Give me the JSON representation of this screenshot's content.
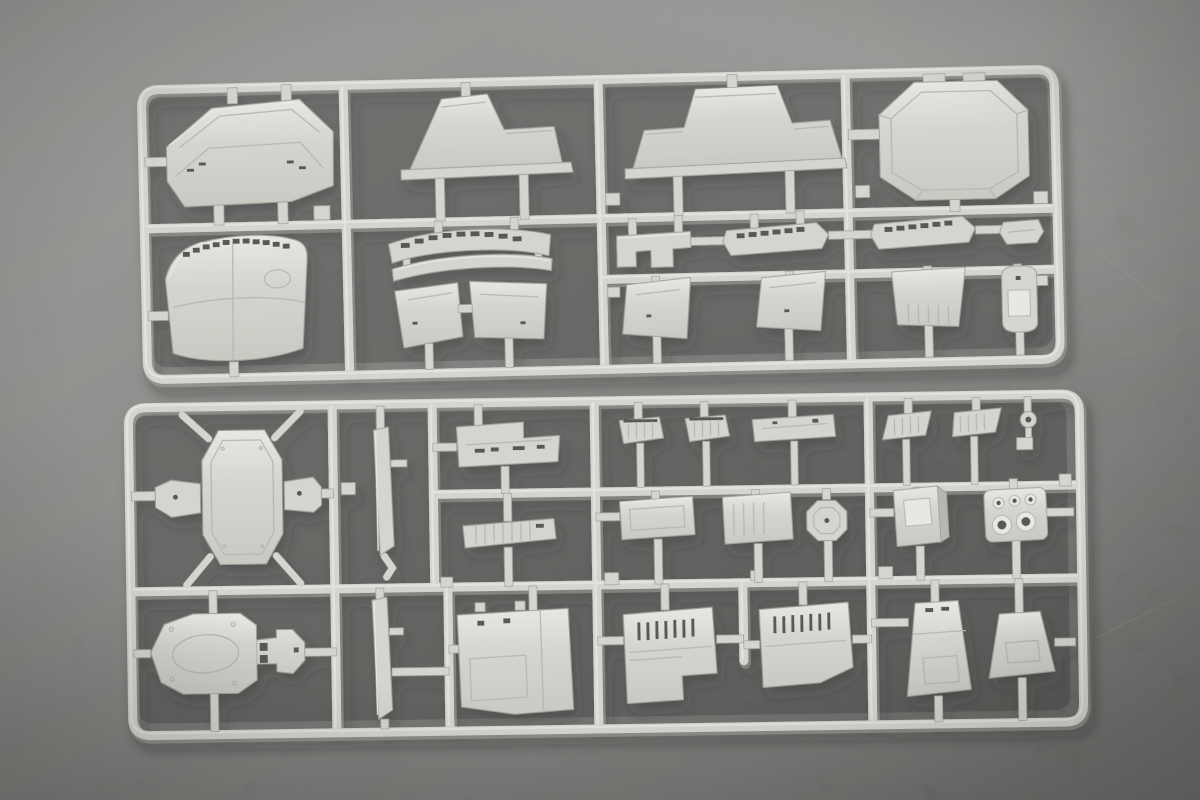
{
  "scene": {
    "type": "product photograph",
    "subject": "Two light-grey injection-moulded polystyrene sprues (part frames) of an unassembled plastic model warship kit, lying on a dark grey mottled backdrop",
    "description": "Photograph of two plastic model kit sprues containing ship superstructure panels, deck platforms, vents, funnels and hatches in light grey styrene on a dark grey textured background",
    "sprue_count": 2,
    "text_visible": "none"
  },
  "colors": {
    "bg_light": "#8f8f8d",
    "bg_mid": "#747472",
    "bg_dark": "#4f4f4d",
    "plastic_base": "#d8d7d1",
    "plastic_highlight": "#efeee9",
    "plastic_mid_shade": "#c9c8c1",
    "plastic_shadow": "#b2b1aa",
    "plastic_edge": "#96958e",
    "slot_color": "#3a3a37",
    "interior_shadow": "rgba(16,16,14,0.26)",
    "cast_shadow": "#171715"
  },
  "sprues": [
    {
      "id": "sprue-top",
      "label": "upper sprue",
      "aria": "Upper sprue with large superstructure and deckhouse panels",
      "parts": [
        {
          "id": "a1",
          "desc": "chamfered transom plate with bevelled panel lines"
        },
        {
          "id": "a2",
          "desc": "stepped deckhouse side profile, left-hand"
        },
        {
          "id": "a3",
          "desc": "stepped deckhouse side profile, right-hand, with base flange"
        },
        {
          "id": "a4",
          "desc": "large chamfered deckhouse rear panel with inner bevel"
        },
        {
          "id": "a5",
          "desc": "curved bridge shroud panel with row of dark window slots"
        },
        {
          "id": "a6",
          "desc": "curved bridge window strip with dark slots"
        },
        {
          "id": "a7",
          "desc": "thin curved trim strip"
        },
        {
          "id": "a8",
          "desc": "pair of angled bulkhead panels"
        },
        {
          "id": "a9",
          "desc": "goalpost bracket fitting"
        },
        {
          "id": "a10",
          "desc": "slanted window strip A with dark slots"
        },
        {
          "id": "a11",
          "desc": "slanted window strip B with dark slots"
        },
        {
          "id": "a12",
          "desc": "small trapezoid tab"
        },
        {
          "id": "a13",
          "desc": "slanted bulkhead panel, left"
        },
        {
          "id": "a14",
          "desc": "slanted bulkhead panel, right"
        },
        {
          "id": "a15",
          "desc": "tapered panel with ribbed lower edge"
        },
        {
          "id": "a16",
          "desc": "round-topped pedestal with square recess"
        }
      ]
    },
    {
      "id": "sprue-bottom",
      "label": "lower sprue",
      "aria": "Lower sprue with platform decks, vents, hatches and funnel panels",
      "parts": [
        {
          "id": "b1",
          "desc": "octagonal platform deck with two hexagonal side tabs"
        },
        {
          "id": "b2",
          "desc": "narrow vertical blade strip"
        },
        {
          "id": "b3",
          "desc": "stepped deck panel with dark fittings"
        },
        {
          "id": "b4",
          "desc": "ribbed slanted strip"
        },
        {
          "id": "b5",
          "desc": "small louvered vent, 1"
        },
        {
          "id": "b6",
          "desc": "small louvered vent, 2"
        },
        {
          "id": "b7",
          "desc": "low wide panel"
        },
        {
          "id": "b8",
          "desc": "rectangular hatch panel with recess"
        },
        {
          "id": "b9",
          "desc": "ribbed rectangular panel"
        },
        {
          "id": "b10",
          "desc": "octagonal disc with centre hole"
        },
        {
          "id": "b11",
          "desc": "parallelogram vent, 1"
        },
        {
          "id": "b12",
          "desc": "parallelogram vent, 2"
        },
        {
          "id": "b13",
          "desc": "small eyelet ring"
        },
        {
          "id": "b14",
          "desc": "square hatch coaming with raised frame"
        },
        {
          "id": "b15",
          "desc": "exhaust block with three small and two large round openings"
        },
        {
          "id": "b16",
          "desc": "keyhole-shaped platform deck with oval recess and slots"
        },
        {
          "id": "b17",
          "desc": "narrow vertical blade strip, 2"
        },
        {
          "id": "b18",
          "desc": "tall recessed panel with step"
        },
        {
          "id": "b19",
          "desc": "louvered trapezoid panel with bottom notch, 1"
        },
        {
          "id": "b20",
          "desc": "louvered trapezoid panel with bottom notch, 2"
        },
        {
          "id": "b21",
          "desc": "tall tapered funnel panel with recessed foot"
        },
        {
          "id": "b22",
          "desc": "short tapered funnel panel with recessed foot"
        }
      ]
    }
  ]
}
